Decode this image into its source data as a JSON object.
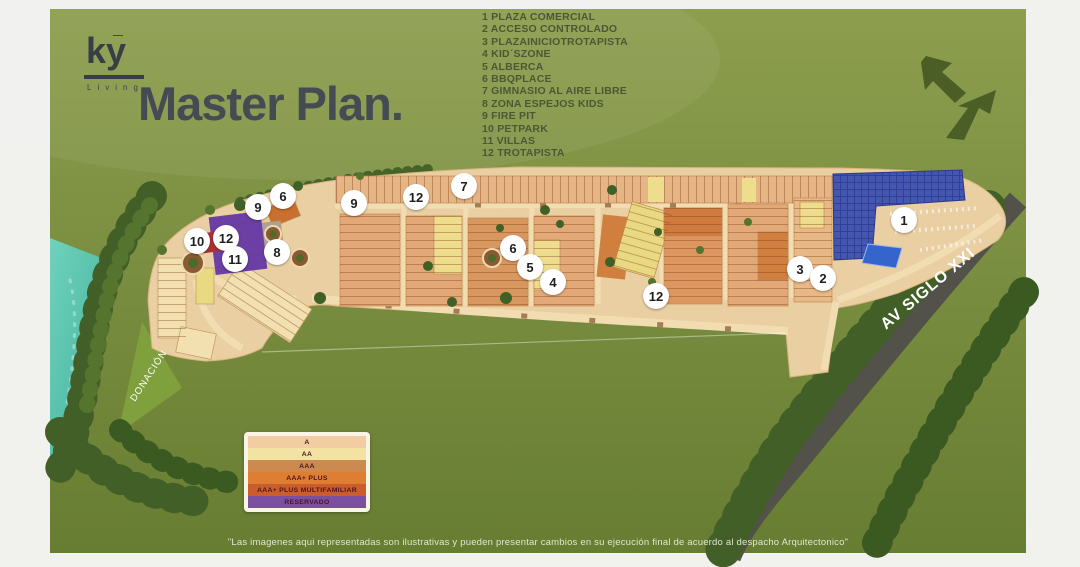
{
  "logo": {
    "text": "ky",
    "subtext": "Living"
  },
  "title": "Master Plan.",
  "amenities": [
    "1 PLAZA COMERCIAL",
    "2 ACCESO CONTROLADO",
    "3 PLAZAINICIOTROTAPISTA",
    "4 KID´SZONE",
    "5 ALBERCA",
    "6 BBQPLACE",
    "7 GIMNASIO AL AIRE LIBRE",
    "8 ZONA ESPEJOS KIDS",
    "9 FIRE PIT",
    "10 PETPARK",
    "11 VILLAS",
    "12 TROTAPISTA"
  ],
  "map": {
    "street_label": "AV SIGLO XXI",
    "donacion_label": "DONACIÓN",
    "markers": [
      {
        "num": "7",
        "x": 464,
        "y": 186
      },
      {
        "num": "6",
        "x": 283,
        "y": 196
      },
      {
        "num": "12",
        "x": 416,
        "y": 197
      },
      {
        "num": "9",
        "x": 354,
        "y": 203
      },
      {
        "num": "9",
        "x": 258,
        "y": 207
      },
      {
        "num": "10",
        "x": 197,
        "y": 241
      },
      {
        "num": "12",
        "x": 226,
        "y": 238
      },
      {
        "num": "11",
        "x": 235,
        "y": 259
      },
      {
        "num": "8",
        "x": 277,
        "y": 252
      },
      {
        "num": "6",
        "x": 513,
        "y": 248
      },
      {
        "num": "5",
        "x": 530,
        "y": 267
      },
      {
        "num": "4",
        "x": 553,
        "y": 282
      },
      {
        "num": "12",
        "x": 656,
        "y": 296
      },
      {
        "num": "1",
        "x": 904,
        "y": 220
      },
      {
        "num": "3",
        "x": 800,
        "y": 269
      },
      {
        "num": "2",
        "x": 823,
        "y": 278
      }
    ]
  },
  "legend": {
    "rows": [
      {
        "label": "A",
        "color": "#f3cda2"
      },
      {
        "label": "AA",
        "color": "#f3e3a3"
      },
      {
        "label": "AAA",
        "color": "#cd8a50"
      },
      {
        "label": "AAA+ PLUS",
        "color": "#dd7e33"
      },
      {
        "label": "AAA+ PLUS MULTIFAMILIAR",
        "color": "#cb5c2b"
      },
      {
        "label": "RESERVADO",
        "color": "#7b50a1"
      }
    ]
  },
  "disclaimer": "\"Las imagenes aqui representadas son ilustrativas y pueden presentar cambios en su ejecución final de acuerdo al despacho Arquitectonico\"",
  "colors": {
    "slide_top": "#8d9e4e",
    "slide_bottom": "#677d31",
    "title_text": "#454b52",
    "list_text": "#4c5834",
    "water": "#5cc6b0",
    "road": "#55544a",
    "lots_base": "#e9cfa2",
    "reserved_purple": "#6b3fa6",
    "commercial_blue": "#4456b0"
  }
}
